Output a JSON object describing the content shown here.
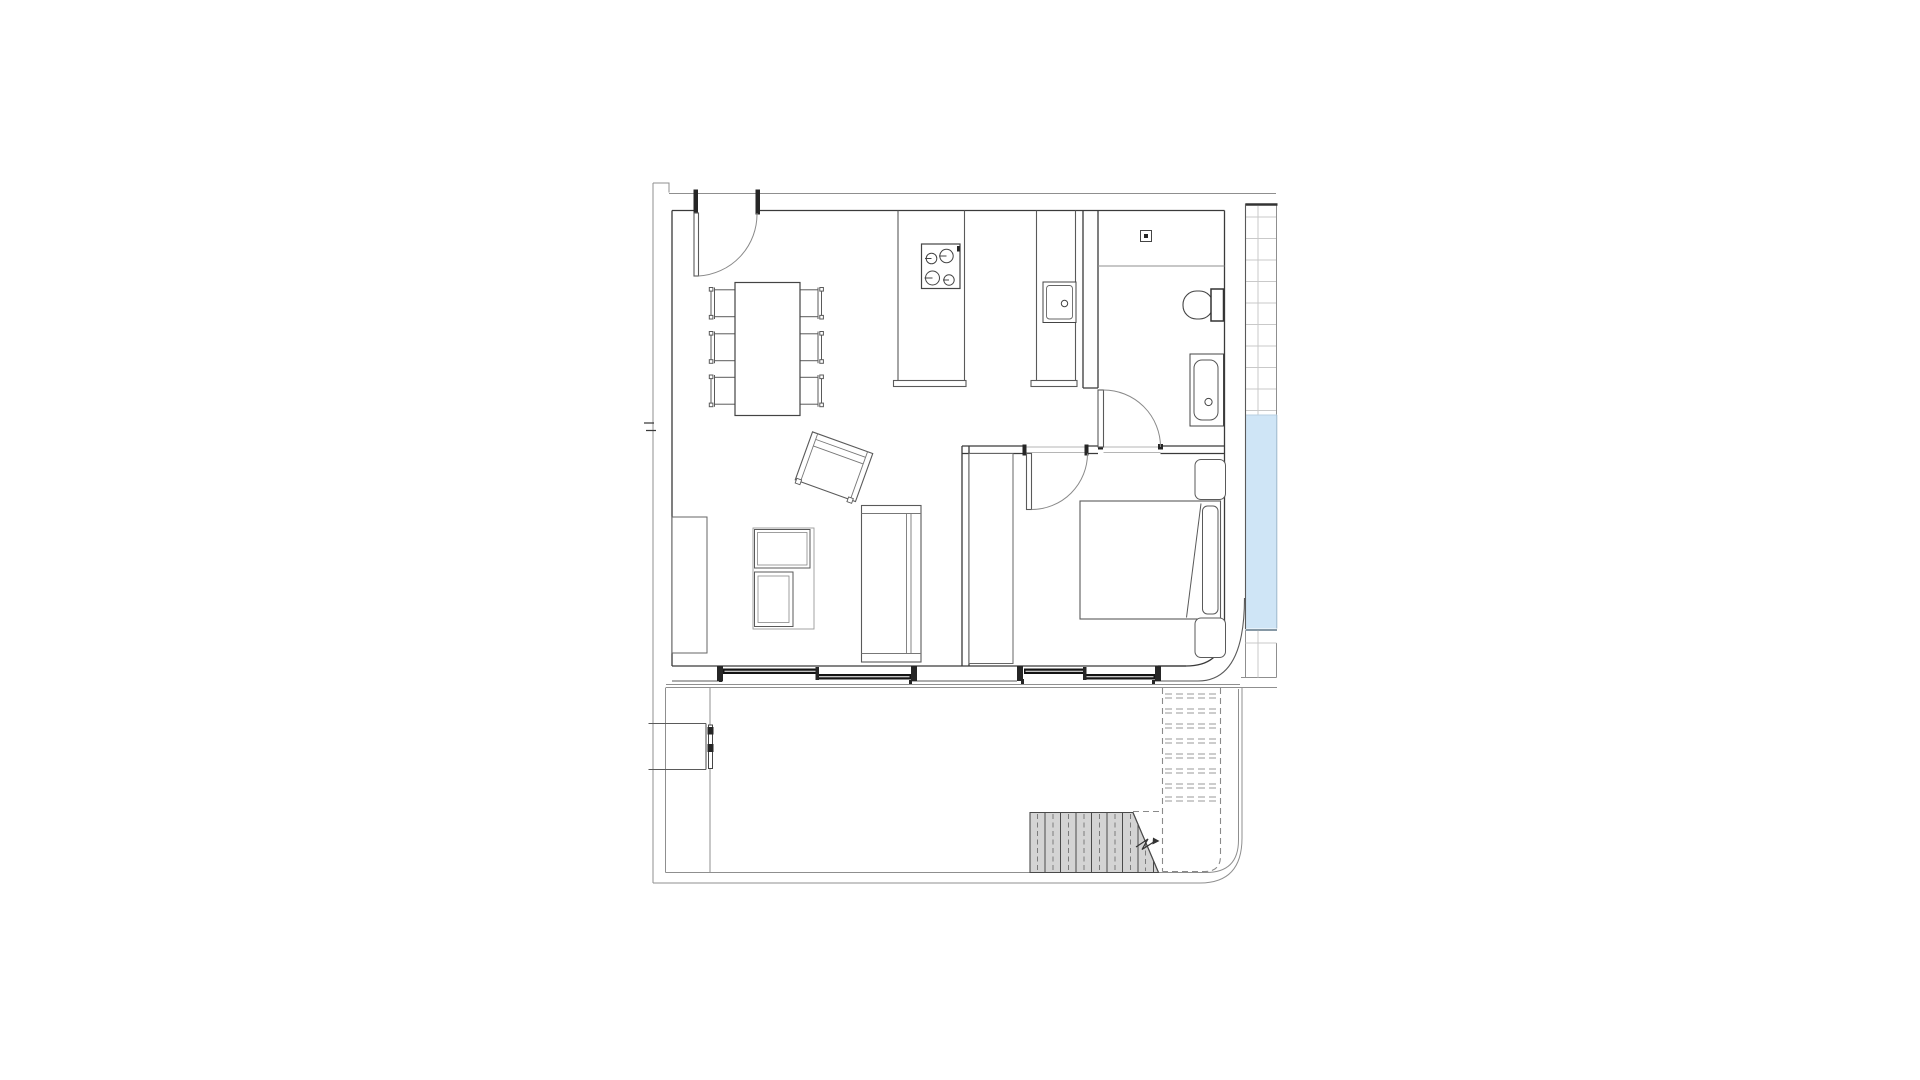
{
  "canvas": {
    "width": 1920,
    "height": 1080,
    "background": "#ffffff"
  },
  "colors": {
    "wall_line": "#3a3a3a",
    "furniture_line": "#5a5a5a",
    "thin_line": "#8f8f8f",
    "tile_grid_line": "#d2d2d2",
    "glazing_dark": "#141414",
    "pool_water": "#cfe5f6",
    "pool_edge": "#9db8cc",
    "pool_bottom_line": "#5f7687",
    "stair_fill": "#d4d4d4",
    "stair_line": "#4a4a4a",
    "dashed_line": "#8a8a8a"
  },
  "floorplan": {
    "type": "apartment-floor-plan",
    "rooms": [
      {
        "name": "kitchen-dining"
      },
      {
        "name": "living-room"
      },
      {
        "name": "bedroom"
      },
      {
        "name": "bathroom"
      },
      {
        "name": "terrace"
      },
      {
        "name": "pool-deck"
      }
    ],
    "fixtures": [
      "entry-door",
      "dining-table",
      "dining-chairs",
      "kitchen-island",
      "cooktop-4-burners",
      "kitchen-counter",
      "sink",
      "shower-drain",
      "toilet",
      "washbasin",
      "bathroom-door",
      "bedroom-door",
      "wardrobe",
      "double-bed",
      "pillow",
      "nightstands",
      "armchair",
      "tv-unit",
      "sideboard",
      "sofa",
      "sliding-window-living",
      "sliding-window-bedroom",
      "terrace-gate",
      "exterior-stairs",
      "upper-stairs-dashed",
      "swimming-pool",
      "tiled-strip"
    ],
    "counts": {
      "dining_chairs": 6,
      "burners": 4,
      "nightstands": 2,
      "sliding_windows": 2,
      "stair_treads": 8
    }
  }
}
